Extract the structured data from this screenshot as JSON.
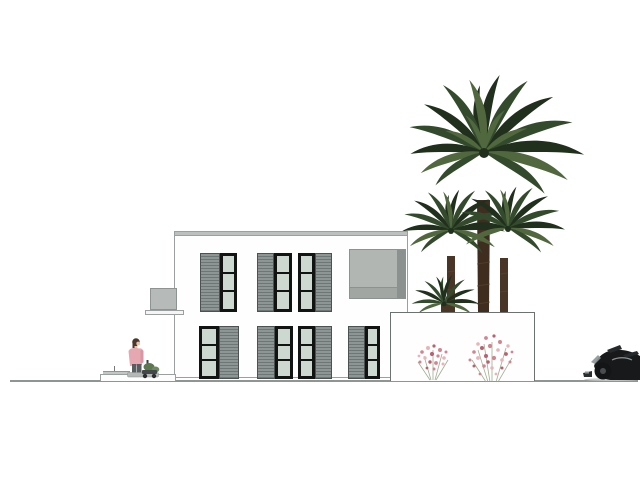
{
  "scene": {
    "type": "architectural-elevation-drawing",
    "elements": [
      {
        "name": "two-story-villa",
        "window_groups_upper": 3,
        "window_groups_lower": 4,
        "parts": [
          "flat-roof-parapet",
          "louvered-sliding-shutters",
          "glass-windows",
          "recessed-balcony-panel",
          "side-balcony",
          "terrace-platform"
        ]
      },
      {
        "name": "garden-planter-wall"
      },
      {
        "name": "palm-trees",
        "count": 4
      },
      {
        "name": "flowering-shrubs",
        "count": 2
      },
      {
        "name": "person-figure"
      },
      {
        "name": "scooter"
      },
      {
        "name": "motorcycle"
      },
      {
        "name": "ground-line"
      }
    ]
  },
  "colors": {
    "background": "#ffffff",
    "outline": "#9aa0a0",
    "wall_white": "#fefefe",
    "wall_edge": "#6b7271",
    "parapet_gray": "#bcc0be",
    "louver_gray": "#8e9695",
    "louver_stripe": "#6e7675",
    "louver_border": "#4b5251",
    "glass_green": "#cdd8d1",
    "frame_black": "#121413",
    "panel_gray": "#b2b6b3",
    "panel_gray_dark": "#a2a6a3",
    "panel_strip_dark": "#8b918e",
    "railing_gray": "#b6bab8",
    "ground_line": "#8f9593",
    "palm_dark": "#20301c",
    "palm_mid": "#334b2c",
    "palm_light": "#51683f",
    "trunk_brown": "#3f2d20",
    "trunk_brown2": "#4a3627",
    "trunk_light": "#5f4733",
    "flower_pink": "#d4838f",
    "flower_deep": "#bd5f71",
    "flower_light": "#e9b3ba",
    "stem_green": "#97a585",
    "shirt_pink": "#e5a7b0",
    "shirt_pink_dark": "#d897a3",
    "hair_brown": "#4c382b",
    "skin": "#e6c2a7",
    "pants_dark": "#585d60",
    "scooter_green": "#5d7751",
    "scooter_green2": "#6c8a5e",
    "bike_black": "#17191b",
    "bike_dark": "#26292c",
    "bike_gray": "#8e9397"
  }
}
